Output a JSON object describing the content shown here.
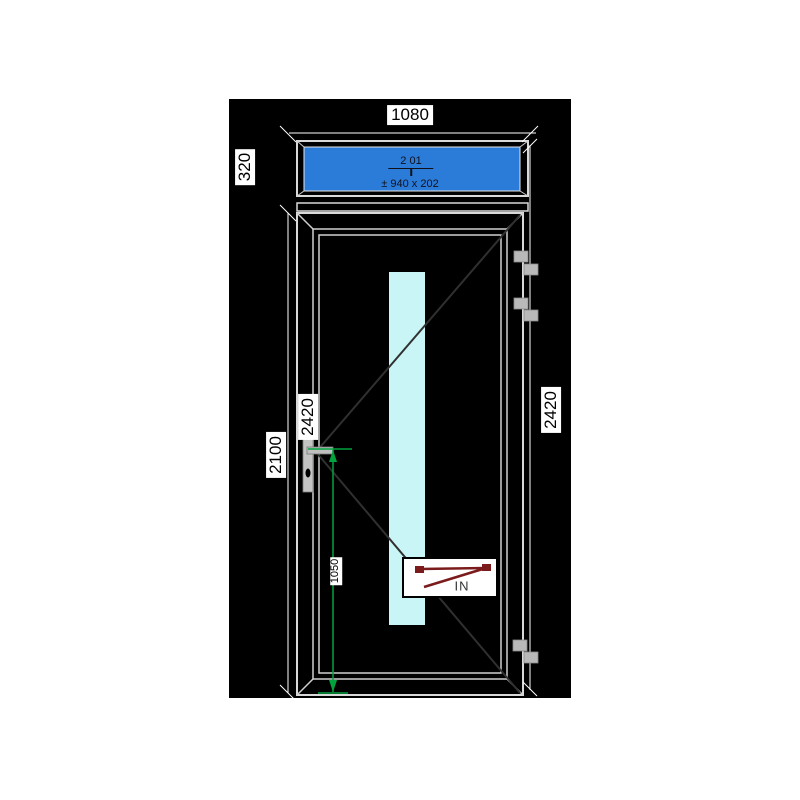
{
  "page": {
    "background": "#ffffff"
  },
  "canvas": {
    "color": "#000000"
  },
  "dimensions": {
    "frame_width": "1080",
    "transom_height": "320",
    "total_height_left": "2420",
    "door_height": "2100",
    "total_height_right": "2420",
    "handle_height": "1050"
  },
  "transom": {
    "position_label": "2 01",
    "glass_size_label": "± 940 x 202",
    "glass_color": "#2b7cd9"
  },
  "door": {
    "in_label": "IN",
    "glass_color": "#c9f5f7",
    "swing_line_color": "#303030"
  },
  "colors": {
    "frame_line": "#d9d9d9",
    "dimension_line": "#ffffff",
    "dimension_green": "#00a33e",
    "direction_arrow_maroon": "#7b1b1b",
    "hinge_gray": "#b9b9b9",
    "handle_gray": "#c4c4c4",
    "label_text": "#000000",
    "label_background": "#ffffff"
  }
}
